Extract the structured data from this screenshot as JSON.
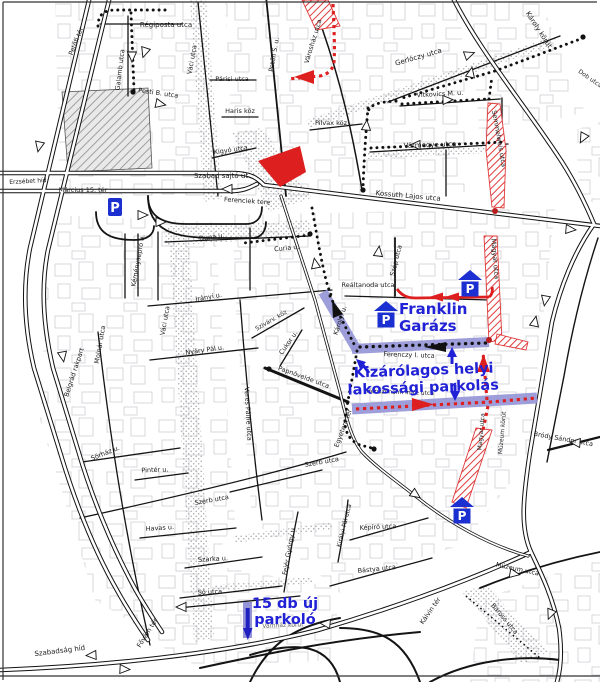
{
  "map": {
    "annotations": {
      "franklin_line1": "Franklin",
      "franklin_line2": "Garázs",
      "exclusive_line1": "Kizárólagos helyi",
      "exclusive_line2": "lakossági parkolás",
      "new_parking_line1": "15 db új",
      "new_parking_line2": "parkoló"
    },
    "colors": {
      "accent_text": "#2121d6",
      "parking_blue": "#1c2fd0",
      "band_blue": "#9494d6",
      "route_red": "#dd1f1f",
      "hatch_red": "#e03a3a",
      "road_black": "#111111"
    },
    "parking_icons": [
      {
        "type": "sign",
        "label": "P",
        "x": 115,
        "y": 207
      },
      {
        "type": "garage",
        "label": "P",
        "x": 470,
        "y": 283
      },
      {
        "type": "garage",
        "label": "P",
        "x": 386,
        "y": 314
      },
      {
        "type": "garage",
        "label": "P",
        "x": 462,
        "y": 510
      }
    ],
    "street_labels": [
      {
        "text": "Régiposta utca",
        "x": 166,
        "y": 27,
        "r": 0,
        "fs": 7
      },
      {
        "text": "Petőfi tér",
        "x": 78,
        "y": 42,
        "r": -68,
        "fs": 6.5
      },
      {
        "text": "Galamb utca",
        "x": 122,
        "y": 70,
        "r": -83,
        "fs": 6.5
      },
      {
        "text": "Váci utca",
        "x": 194,
        "y": 60,
        "r": -80,
        "fs": 6.5
      },
      {
        "text": "Pesti B. utca",
        "x": 158,
        "y": 95,
        "r": 8,
        "fs": 6.5
      },
      {
        "text": "Petőfi S. u.",
        "x": 276,
        "y": 55,
        "r": -80,
        "fs": 6.5
      },
      {
        "text": "Párisi utca",
        "x": 232,
        "y": 81,
        "r": 0,
        "fs": 6.5
      },
      {
        "text": "Haris köz",
        "x": 240,
        "y": 113,
        "r": 0,
        "fs": 6.5
      },
      {
        "text": "Kígyó utca",
        "x": 231,
        "y": 152,
        "r": -8,
        "fs": 6.5
      },
      {
        "text": "Szabad sajtó út",
        "x": 221,
        "y": 178,
        "r": 0,
        "fs": 7
      },
      {
        "text": "Erzsébet híd",
        "x": 28,
        "y": 183,
        "r": -3,
        "fs": 6
      },
      {
        "text": "Március 15. tér",
        "x": 83,
        "y": 192,
        "r": 0,
        "fs": 6.5
      },
      {
        "text": "Ferenciek tere",
        "x": 247,
        "y": 203,
        "r": 4,
        "fs": 6.5
      },
      {
        "text": "Városház utca",
        "x": 315,
        "y": 42,
        "r": -73,
        "fs": 6.5
      },
      {
        "text": "Gerlóczy utca",
        "x": 419,
        "y": 59,
        "r": -16,
        "fs": 7
      },
      {
        "text": "Vitkovics M. u.",
        "x": 440,
        "y": 96,
        "r": -3,
        "fs": 6.5
      },
      {
        "text": "Pilvax köz",
        "x": 331,
        "y": 125,
        "r": 0,
        "fs": 6.5
      },
      {
        "text": "Vármegye utca",
        "x": 430,
        "y": 147,
        "r": -2,
        "fs": 7
      },
      {
        "text": "Kossuth Lajos utca",
        "x": 408,
        "y": 198,
        "r": 5,
        "fs": 7
      },
      {
        "text": "Károly körút",
        "x": 537,
        "y": 31,
        "r": 57,
        "fs": 7
      },
      {
        "text": "Dob utca",
        "x": 589,
        "y": 80,
        "r": 35,
        "fs": 6
      },
      {
        "text": "Semmelweis utca",
        "x": 497,
        "y": 139,
        "r": 80,
        "fs": 6.5
      },
      {
        "text": "Duna u.",
        "x": 212,
        "y": 239,
        "r": -8,
        "fs": 6.5
      },
      {
        "text": "Curia u.",
        "x": 287,
        "y": 250,
        "r": -6,
        "fs": 6.5
      },
      {
        "text": "Kéményseprő u.",
        "x": 140,
        "y": 261,
        "r": -80,
        "fs": 6.5
      },
      {
        "text": "Irányi u.",
        "x": 209,
        "y": 299,
        "r": -10,
        "fs": 6.5
      },
      {
        "text": "Váci utca",
        "x": 167,
        "y": 321,
        "r": -80,
        "fs": 6.5
      },
      {
        "text": "Molnár utca",
        "x": 102,
        "y": 345,
        "r": -80,
        "fs": 6.5
      },
      {
        "text": "Belgrád rakpart",
        "x": 76,
        "y": 373,
        "r": -72,
        "fs": 6.5
      },
      {
        "text": "Szivárv. köz",
        "x": 272,
        "y": 322,
        "r": -30,
        "fs": 6
      },
      {
        "text": "Cukor u.",
        "x": 290,
        "y": 344,
        "r": -55,
        "fs": 6.5
      },
      {
        "text": "Papnövelde utca",
        "x": 303,
        "y": 379,
        "r": 20,
        "fs": 6.5
      },
      {
        "text": "Veres Pálné utca",
        "x": 246,
        "y": 414,
        "r": 87,
        "fs": 6.5
      },
      {
        "text": "Nyáry Pál u.",
        "x": 205,
        "y": 352,
        "r": -8,
        "fs": 6.5
      },
      {
        "text": "Károlyi u.",
        "x": 342,
        "y": 321,
        "r": -72,
        "fs": 6.5
      },
      {
        "text": "Szép utca",
        "x": 398,
        "y": 261,
        "r": -76,
        "fs": 6.5
      },
      {
        "text": "Reáltanoda utca",
        "x": 368,
        "y": 287,
        "r": 0,
        "fs": 6.5
      },
      {
        "text": "Magyar utca",
        "x": 493,
        "y": 259,
        "r": 85,
        "fs": 6.5
      },
      {
        "text": "Ferenczy I. utca",
        "x": 409,
        "y": 357,
        "r": 2,
        "fs": 6.5
      },
      {
        "text": "Henszlmann Imre utca",
        "x": 400,
        "y": 394,
        "r": 2,
        "fs": 6
      },
      {
        "text": "Magyar utca",
        "x": 483,
        "y": 432,
        "r": -85,
        "fs": 6
      },
      {
        "text": "Múzeum körút",
        "x": 504,
        "y": 433,
        "r": -85,
        "fs": 6
      },
      {
        "text": "Bródy Sándor utca",
        "x": 563,
        "y": 441,
        "r": 10,
        "fs": 6.5
      },
      {
        "text": "Múzeum utca",
        "x": 517,
        "y": 571,
        "r": 12,
        "fs": 6.5
      },
      {
        "text": "Baross utca",
        "x": 503,
        "y": 620,
        "r": 50,
        "fs": 6.5
      },
      {
        "text": "Kálvin tér",
        "x": 432,
        "y": 612,
        "r": -55,
        "fs": 6.5
      },
      {
        "text": "Egyetem tér",
        "x": 345,
        "y": 429,
        "r": -70,
        "fs": 6.5
      },
      {
        "text": "Szerb utca",
        "x": 212,
        "y": 502,
        "r": -10,
        "fs": 6.5
      },
      {
        "text": "Szerb utca",
        "x": 322,
        "y": 464,
        "r": -10,
        "fs": 6.5
      },
      {
        "text": "Fejér György u.",
        "x": 291,
        "y": 551,
        "r": -80,
        "fs": 6.5
      },
      {
        "text": "Királyi Pál utca",
        "x": 346,
        "y": 526,
        "r": -76,
        "fs": 6
      },
      {
        "text": "Képíró utca",
        "x": 378,
        "y": 529,
        "r": -3,
        "fs": 6.5
      },
      {
        "text": "Bástya utca",
        "x": 377,
        "y": 571,
        "r": -6,
        "fs": 6.5
      },
      {
        "text": "Sörház u.",
        "x": 106,
        "y": 455,
        "r": -22,
        "fs": 6.5
      },
      {
        "text": "Pintér u.",
        "x": 155,
        "y": 472,
        "r": -2,
        "fs": 6.5
      },
      {
        "text": "Havas u.",
        "x": 160,
        "y": 530,
        "r": -4,
        "fs": 6.5
      },
      {
        "text": "Szarka u.",
        "x": 213,
        "y": 561,
        "r": -3,
        "fs": 6.5
      },
      {
        "text": "Só utca",
        "x": 210,
        "y": 594,
        "r": -3,
        "fs": 6.5
      },
      {
        "text": "Fővám tér",
        "x": 149,
        "y": 634,
        "r": -58,
        "fs": 6.5
      },
      {
        "text": "Szabadság híd",
        "x": 60,
        "y": 653,
        "r": -7,
        "fs": 7
      },
      {
        "text": "Vámház körút",
        "x": 283,
        "y": 627,
        "r": -2,
        "fs": 6,
        "cls": "dim"
      }
    ]
  }
}
